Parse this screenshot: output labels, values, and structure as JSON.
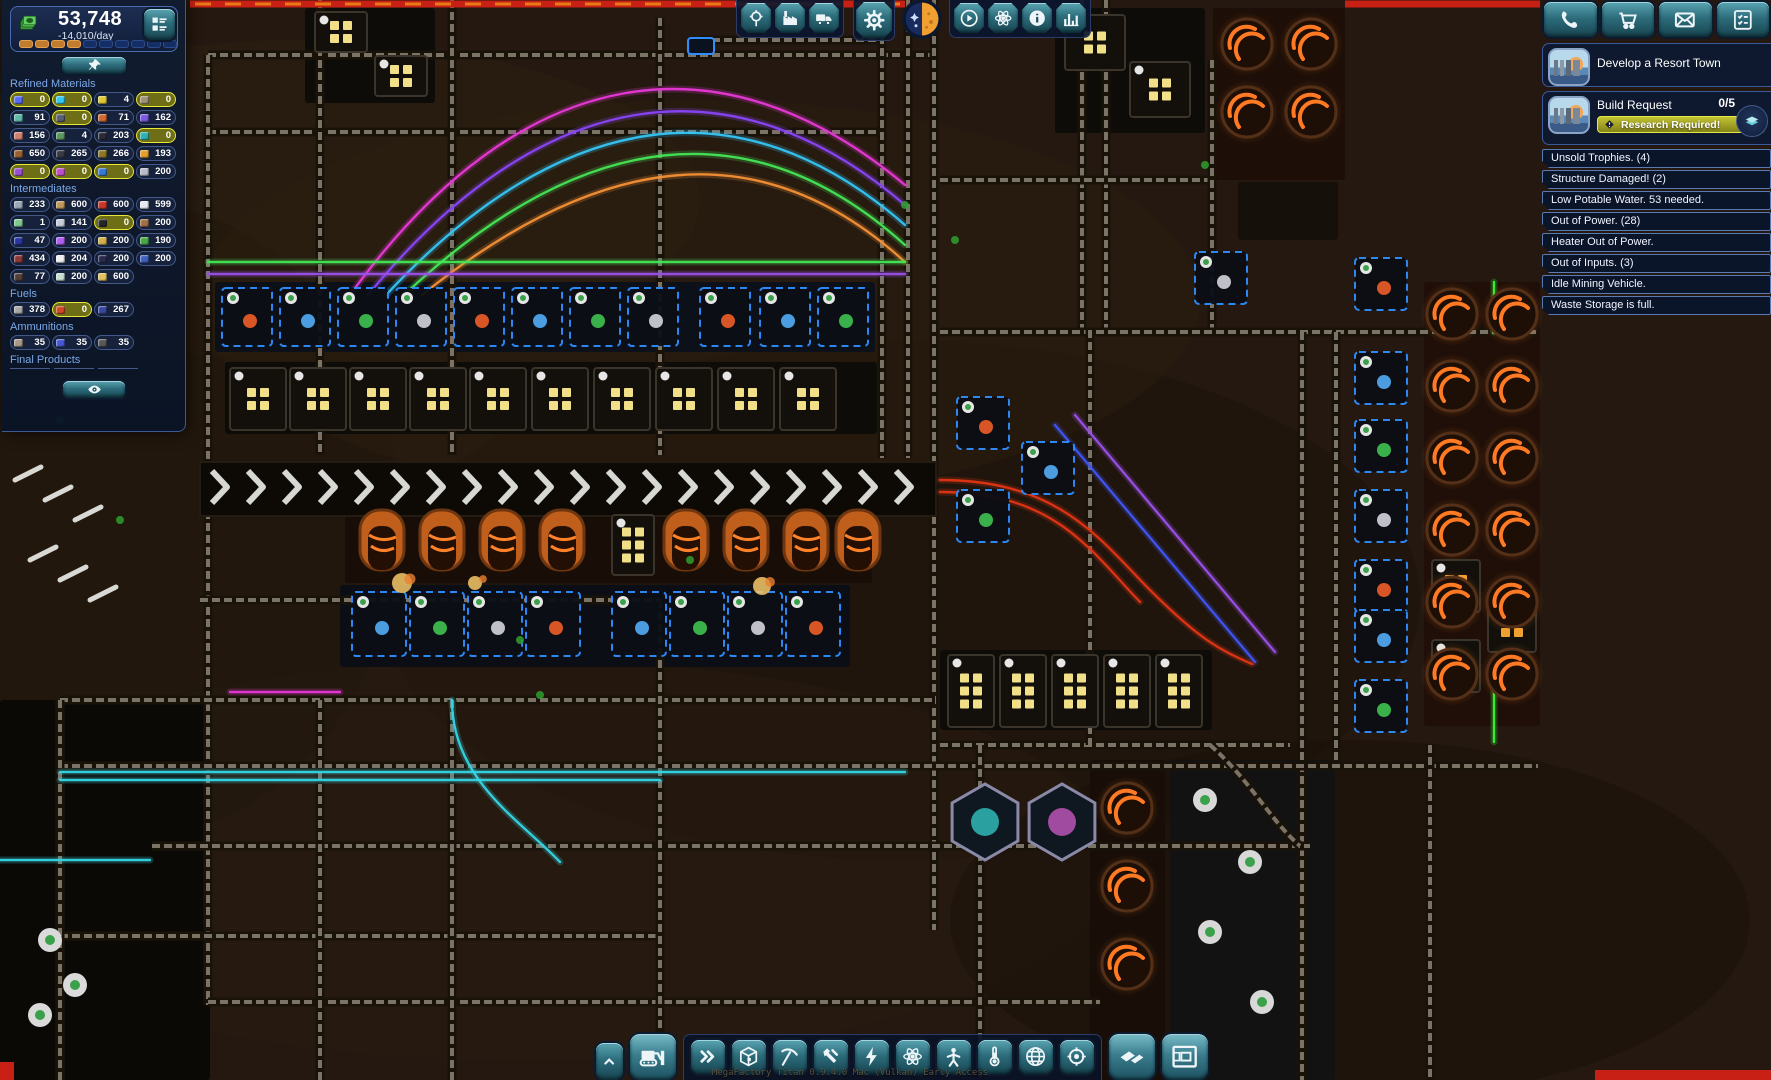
{
  "hud": {
    "money": {
      "value": "53,748",
      "rate": "-14,010/day",
      "progress_filled": 4,
      "progress_total": 10,
      "fill_color": "#c07c2c",
      "empty_color": "#152e66"
    },
    "portfolio_button_icon": "portfolio-icon",
    "pin_button_icon": "pin-icon",
    "visibility_button_icon": "eye-icon"
  },
  "resources": {
    "sections": [
      {
        "label": "Refined Materials",
        "stubs": 0,
        "rows": [
          [
            {
              "v": "0",
              "c": "#5a6cf0",
              "hl": true
            },
            {
              "v": "0",
              "c": "#35c8f0",
              "hl": true
            },
            {
              "v": "4",
              "c": "#e0c838"
            },
            {
              "v": "0",
              "c": "#a09078",
              "hl": true
            }
          ],
          [
            {
              "v": "91",
              "c": "#5fb8a8"
            },
            {
              "v": "0",
              "c": "#5a6070",
              "hl": true
            },
            {
              "v": "71",
              "c": "#d06a30"
            },
            {
              "v": "162",
              "c": "#7a5ae0"
            }
          ],
          [
            {
              "v": "156",
              "c": "#d08070"
            },
            {
              "v": "4",
              "c": "#5a9860"
            },
            {
              "v": "203",
              "c": "#2a2a38"
            },
            {
              "v": "0",
              "c": "#30b0b0",
              "hl": true
            }
          ],
          [
            {
              "v": "650",
              "c": "#9a6034"
            },
            {
              "v": "265",
              "c": "#3a3a44"
            },
            {
              "v": "266",
              "c": "#8a7828"
            },
            {
              "v": "193",
              "c": "#e0a030"
            }
          ],
          [
            {
              "v": "0",
              "c": "#9a50d0",
              "hl": true
            },
            {
              "v": "0",
              "c": "#c050c8",
              "hl": true
            },
            {
              "v": "0",
              "c": "#3878d0",
              "hl": true
            },
            {
              "v": "200",
              "c": "#b8bcc8"
            }
          ]
        ]
      },
      {
        "label": "Intermediates",
        "stubs": 0,
        "rows": [
          [
            {
              "v": "233",
              "c": "#9aa8b8"
            },
            {
              "v": "600",
              "c": "#c09858"
            },
            {
              "v": "600",
              "c": "#c83828"
            },
            {
              "v": "599",
              "c": "#e8e8f0"
            }
          ],
          [
            {
              "v": "1",
              "c": "#80c890"
            },
            {
              "v": "141",
              "c": "#c8ccd8"
            },
            {
              "v": "0",
              "c": "#262626",
              "hl": true
            },
            {
              "v": "200",
              "c": "#a07048"
            }
          ],
          [
            {
              "v": "47",
              "c": "#2838a0"
            },
            {
              "v": "200",
              "c": "#b060f0"
            },
            {
              "v": "200",
              "c": "#d0b050"
            },
            {
              "v": "190",
              "c": "#48a848"
            }
          ],
          [
            {
              "v": "434",
              "c": "#8a3838"
            },
            {
              "v": "204",
              "c": "#f0f0f0"
            },
            {
              "v": "200",
              "c": "#2a2a50"
            },
            {
              "v": "200",
              "c": "#4060c0"
            }
          ],
          [
            {
              "v": "77",
              "c": "#504038"
            },
            {
              "v": "200",
              "c": "#c8e0d0"
            },
            {
              "v": "600",
              "c": "#e0c060"
            }
          ]
        ]
      },
      {
        "label": "Fuels",
        "stubs": 0,
        "rows": [
          [
            {
              "v": "378",
              "c": "#a8a8a8"
            },
            {
              "v": "0",
              "c": "#d04828",
              "hl": true
            },
            {
              "v": "267",
              "c": "#3848a0"
            }
          ]
        ]
      },
      {
        "label": "Ammunitions",
        "stubs": 0,
        "rows": [
          [
            {
              "v": "35",
              "c": "#a89888"
            },
            {
              "v": "35",
              "c": "#4858d0"
            },
            {
              "v": "35",
              "c": "#585858"
            }
          ]
        ]
      },
      {
        "label": "Final Products",
        "stubs": 3,
        "rows": []
      }
    ]
  },
  "top_toolbar": {
    "groups": [
      {
        "style": "strip",
        "buttons": [
          "locator-icon",
          "factory-icon",
          "truck-icon"
        ]
      },
      {
        "style": "tile",
        "buttons": [
          "gear-icon"
        ]
      },
      {
        "style": "circle",
        "buttons": [
          "daynight-icon"
        ]
      },
      {
        "style": "strip",
        "buttons": [
          "play-icon",
          "science-icon",
          "info-icon",
          "stats-icon"
        ]
      }
    ]
  },
  "right_panel": {
    "action_buttons": [
      "phone-icon",
      "cart-icon",
      "mail-icon",
      "tasks-icon"
    ],
    "quests": [
      {
        "title": "Develop a Resort Town"
      },
      {
        "title": "Build Request",
        "count": "0/5",
        "banner": "Research Required!",
        "banner_icon": "warning-icon",
        "badge_icon": "research-icon",
        "banner_color": "#b8b828"
      }
    ],
    "notifications": [
      "Unsold Trophies. (4)",
      "Structure Damaged! (2)",
      "Low Potable Water. 53 needed.",
      "Out of Power. (28)",
      "Heater Out of Power.",
      "Out of Inputs. (3)",
      "Idle Mining Vehicle.",
      "Waste Storage is full."
    ]
  },
  "bottom_toolbar": {
    "buttons": [
      {
        "icon": "collapse-icon",
        "size": "sm"
      },
      {
        "icon": "bulldozer-icon",
        "size": "lg"
      },
      {
        "icon": "fast-forward-icon",
        "size": "md"
      },
      {
        "icon": "box-icon",
        "size": "md"
      },
      {
        "icon": "pickaxe-icon",
        "size": "md"
      },
      {
        "icon": "build-tools-icon",
        "size": "md"
      },
      {
        "icon": "power-icon",
        "size": "md"
      },
      {
        "icon": "science-icon",
        "size": "md"
      },
      {
        "icon": "citizen-icon",
        "size": "md"
      },
      {
        "icon": "thermometer-icon",
        "size": "md"
      },
      {
        "icon": "globe-icon",
        "size": "md"
      },
      {
        "icon": "target-icon",
        "size": "md"
      },
      {
        "icon": "tiles-icon",
        "size": "lg"
      },
      {
        "icon": "blueprint-icon",
        "size": "lg"
      }
    ]
  },
  "status_bar": {
    "text": "MegaFactory Titan 0.9.4.0 Mac (Vulkan) Early Access"
  },
  "colors": {
    "accent_teal": "#2e8f9e",
    "panel_navy": "#101a2e",
    "highlight_yellow": "#e8e838",
    "alert_border": "#5a7ab2",
    "furnace_orange": "#ff7a22",
    "conveyor_white": "#e3e3df"
  }
}
